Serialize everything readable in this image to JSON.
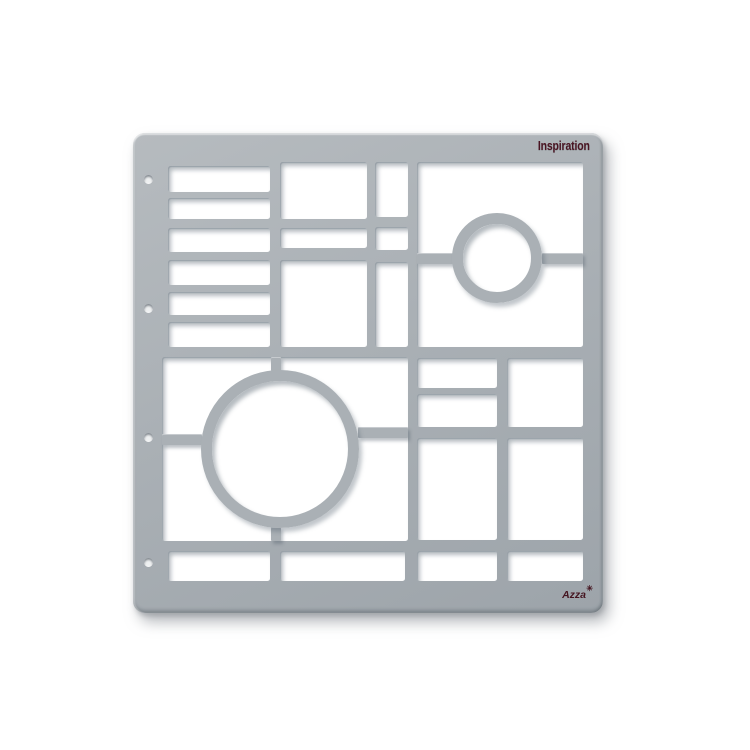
{
  "product": {
    "title_label": "Inspiration",
    "brand": "Azza",
    "sparkle_glyph": "✳",
    "title_color": "#4a1422",
    "board_color": "#aab0b5",
    "background_color": "#ffffff"
  },
  "stencil": {
    "board": {
      "x": 133,
      "y": 133,
      "w": 470,
      "h": 480,
      "corner_radius": 12
    },
    "cutouts": [
      {
        "x": 35,
        "y": 33,
        "w": 102,
        "h": 26
      },
      {
        "x": 35,
        "y": 65,
        "w": 102,
        "h": 21
      },
      {
        "x": 35,
        "y": 95,
        "w": 102,
        "h": 24
      },
      {
        "x": 35,
        "y": 127,
        "w": 102,
        "h": 25
      },
      {
        "x": 35,
        "y": 159,
        "w": 102,
        "h": 23
      },
      {
        "x": 35,
        "y": 189,
        "w": 102,
        "h": 25
      },
      {
        "x": 147,
        "y": 29,
        "w": 87,
        "h": 57
      },
      {
        "x": 147,
        "y": 95,
        "w": 87,
        "h": 20
      },
      {
        "x": 147,
        "y": 127,
        "w": 87,
        "h": 87
      },
      {
        "x": 242,
        "y": 29,
        "w": 33,
        "h": 55
      },
      {
        "x": 242,
        "y": 94,
        "w": 33,
        "h": 23
      },
      {
        "x": 242,
        "y": 129,
        "w": 33,
        "h": 85
      },
      {
        "x": 284,
        "y": 29,
        "w": 166,
        "h": 185
      },
      {
        "x": 29,
        "y": 224,
        "w": 246,
        "h": 184
      },
      {
        "x": 284,
        "y": 225,
        "w": 80,
        "h": 30
      },
      {
        "x": 284,
        "y": 261,
        "w": 80,
        "h": 33
      },
      {
        "x": 374,
        "y": 225,
        "w": 76,
        "h": 69
      },
      {
        "x": 284,
        "y": 305,
        "w": 80,
        "h": 102
      },
      {
        "x": 374,
        "y": 305,
        "w": 76,
        "h": 102
      },
      {
        "x": 35,
        "y": 418,
        "w": 102,
        "h": 30
      },
      {
        "x": 147,
        "y": 418,
        "w": 125,
        "h": 30
      },
      {
        "x": 284,
        "y": 418,
        "w": 80,
        "h": 30
      },
      {
        "x": 374,
        "y": 418,
        "w": 76,
        "h": 30
      }
    ],
    "bridges": [
      {
        "x": 284,
        "y": 120,
        "w": 36,
        "h": 11
      },
      {
        "x": 409,
        "y": 120,
        "w": 41,
        "h": 11
      },
      {
        "x": 138,
        "y": 224,
        "w": 10,
        "h": 14
      },
      {
        "x": 138,
        "y": 394,
        "w": 10,
        "h": 14
      },
      {
        "x": 29,
        "y": 301,
        "w": 40,
        "h": 11
      },
      {
        "x": 225,
        "y": 294,
        "w": 50,
        "h": 11
      }
    ],
    "rings": [
      {
        "cx": 364,
        "cy": 125,
        "r_outer": 45,
        "thickness": 11
      },
      {
        "cx": 147,
        "cy": 316,
        "r_outer": 79,
        "thickness": 11
      }
    ],
    "holes": [
      {
        "cx": 15,
        "cy": 46
      },
      {
        "cx": 15,
        "cy": 175
      },
      {
        "cx": 15,
        "cy": 304
      },
      {
        "cx": 15,
        "cy": 429
      }
    ]
  }
}
